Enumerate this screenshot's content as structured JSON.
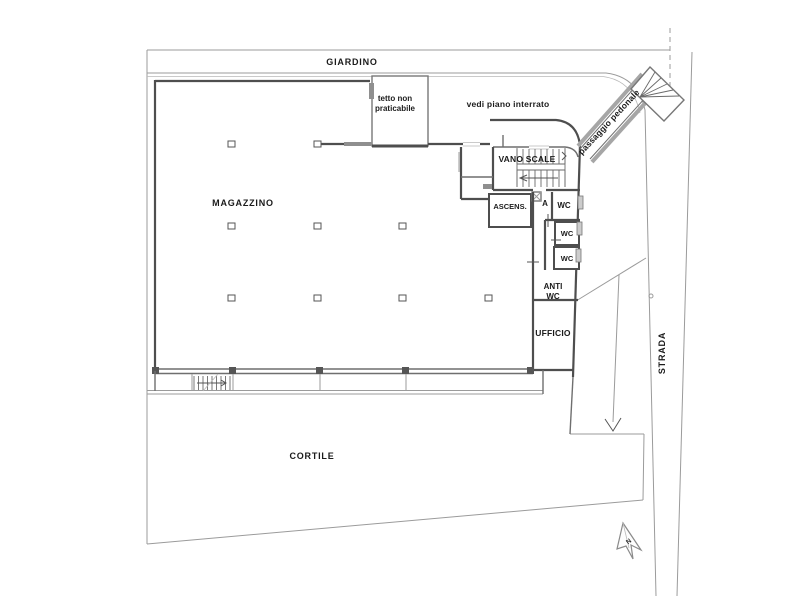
{
  "plan": {
    "labels": {
      "giardino": "GIARDINO",
      "tetto_line1": "tetto non",
      "tetto_line2": "praticabile",
      "vedi_piano": "vedi piano interrato",
      "vano_scale": "VANO SCALE",
      "ascensore": "ASCENS.",
      "vano_a": "A",
      "wc_big": "WC",
      "wc_mid": "WC",
      "wc_small": "WC",
      "anti_line1": "ANTI",
      "anti_line2": "WC",
      "ufficio": "UFFICIO",
      "magazzino": "MAGAZZINO",
      "cortile": "CORTILE",
      "strada": "STRADA",
      "passaggio": "passaggio pedonale",
      "north": "N"
    },
    "columns": [
      [
        228,
        141
      ],
      [
        314,
        141
      ],
      [
        228,
        223
      ],
      [
        314,
        223
      ],
      [
        399,
        223
      ],
      [
        228,
        295
      ],
      [
        314,
        295
      ],
      [
        399,
        295
      ],
      [
        485,
        295
      ]
    ],
    "piers": [
      [
        152,
        367
      ],
      [
        229,
        367
      ],
      [
        316,
        367
      ],
      [
        402,
        367
      ],
      [
        527,
        367
      ]
    ],
    "east_windows": [
      [
        578,
        196
      ],
      [
        577,
        222
      ],
      [
        576,
        249
      ]
    ],
    "colors": {
      "wall": "#4e4e4e",
      "site_line": "#9b9b9b",
      "grey_fill": "#8f8f8f",
      "text": "#1b1b1b",
      "background": "#ffffff"
    }
  }
}
